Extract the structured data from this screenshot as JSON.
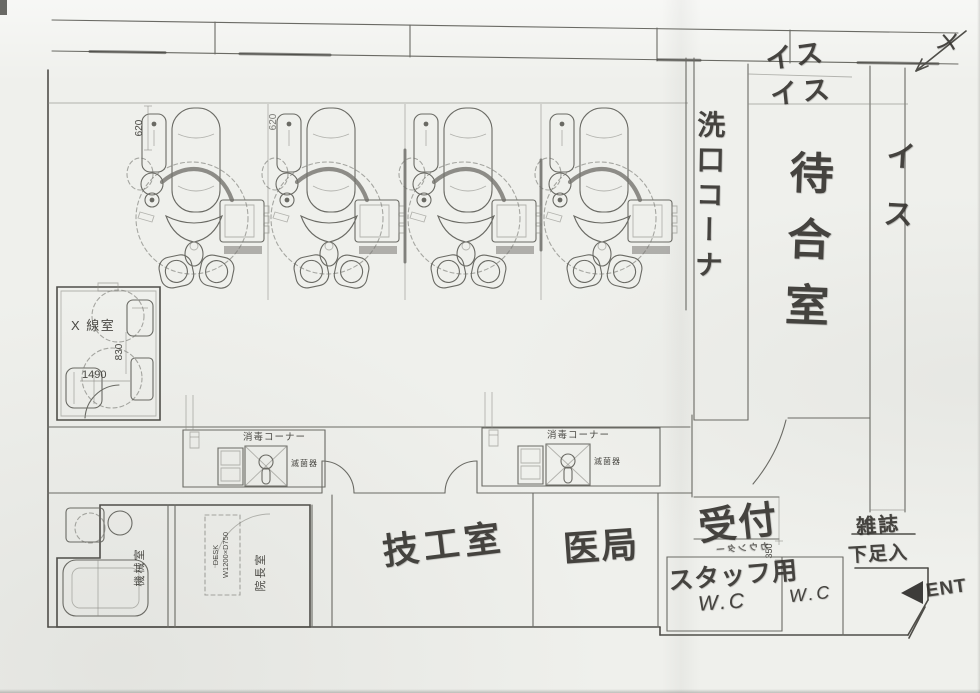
{
  "page": {
    "background": "#eff0ec",
    "pencil_color": "#33312d",
    "print_line_color": "#6a6a64",
    "description": "Hand-annotated scanned floor plan of a dental clinic"
  },
  "labels": {
    "rinse_corner": "洗口コーナ",
    "waiting_room": "待合室",
    "chair_note_1": "イス",
    "chair_note_2": "イス",
    "chair_note_right": "イス",
    "xray_room": "X 線室",
    "lab_room": "技工室",
    "doctors_office": "医局",
    "reception": "受付",
    "counter_note": "カウンター",
    "staff_label": "スタッフ用",
    "staff_wc": "W.C",
    "public_wc": "W.C",
    "magazines": "雑誌",
    "shoe_shelf": "下足入",
    "entrance": "ENT",
    "check_mark": "メ",
    "machine_room": "機械室",
    "director_room": "院長室",
    "desk_line1": "DESK",
    "desk_line2": "W1200×D750",
    "sterilize_corner_1": "消毒コーナー",
    "sterilize_corner_2": "消毒コーナー",
    "sterilizer_1": "滅菌器",
    "sterilizer_2": "滅菌器"
  },
  "dimensions": {
    "unit_pitch_1": "620",
    "unit_pitch_2": "620",
    "xray_depth": "830",
    "xray_width": "1490",
    "counter_depth": "350"
  },
  "equipment": {
    "dental_units_count": "4"
  }
}
